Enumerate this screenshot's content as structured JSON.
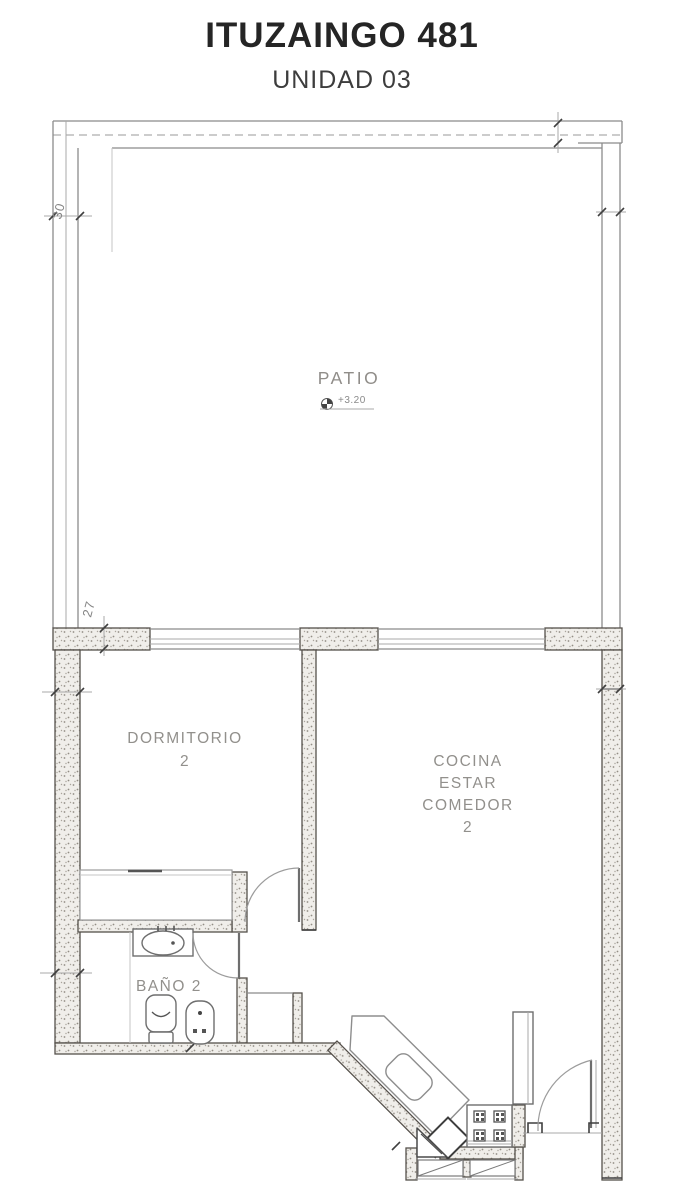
{
  "header": {
    "title": "ITUZAINGO 481",
    "subtitle": "UNIDAD 03"
  },
  "plan": {
    "patio": {
      "label": "PATIO",
      "level_mark": "+3.20"
    },
    "dormitorio": {
      "label": "DORMITORIO",
      "number": "2"
    },
    "cocina_estar_comedor": {
      "line1": "COCINA",
      "line2": "ESTAR",
      "line3": "COMEDOR",
      "number": "2"
    },
    "banio": {
      "label": "BAÑO 2"
    },
    "dimensions": {
      "top_wall": "30",
      "mid_wall": "27"
    },
    "colors": {
      "line": "#8b8b8b",
      "wall_stroke": "#55504b",
      "label": "#92908c",
      "title": "#252525"
    }
  }
}
